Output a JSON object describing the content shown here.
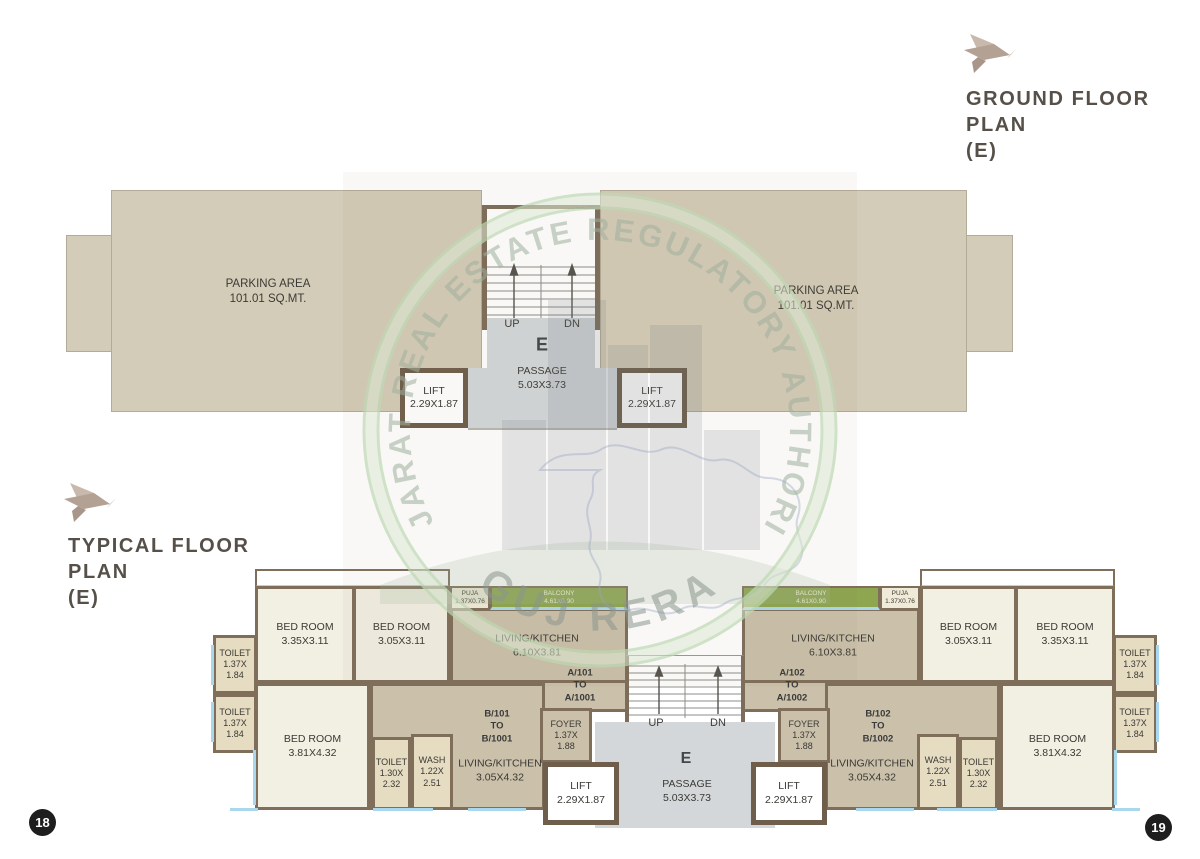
{
  "page_numbers": {
    "left": "18",
    "right": "19"
  },
  "watermark": {
    "arc_text_top": "GUJARAT REAL ESTATE REGULATORY AUTHORITY",
    "arc_text_bottom": "GUJ RERA"
  },
  "ground_plan": {
    "title_lines": [
      "GROUND FLOOR",
      "PLAN",
      "(E)"
    ],
    "parking_left_lines": [
      "PARKING AREA",
      "101.01 SQ.MT."
    ],
    "parking_right_lines": [
      "PARKING AREA",
      "101.01 SQ.MT."
    ],
    "up": "UP",
    "dn": "DN",
    "wing": "E",
    "passage_lines": [
      "PASSAGE",
      "5.03X3.73"
    ],
    "lift_left_lines": [
      "LIFT",
      "2.29X1.87"
    ],
    "lift_right_lines": [
      "LIFT",
      "2.29X1.87"
    ]
  },
  "typical_plan": {
    "title_lines": [
      "TYPICAL FLOOR",
      "PLAN",
      "(E)"
    ],
    "up": "UP",
    "dn": "DN",
    "wing": "E",
    "passage_lines": [
      "PASSAGE",
      "5.03X3.73"
    ],
    "rooms": [
      {
        "id": "toilet-left-upper",
        "lines": [
          "TOILET",
          "1.37X",
          "1.84"
        ]
      },
      {
        "id": "toilet-left-lower",
        "lines": [
          "TOILET",
          "1.37X",
          "1.84"
        ]
      },
      {
        "id": "bedroom-left-1",
        "lines": [
          "BED ROOM",
          "3.35X3.11"
        ]
      },
      {
        "id": "bedroom-left-2",
        "lines": [
          "BED ROOM",
          "3.05X3.11"
        ]
      },
      {
        "id": "puja-left",
        "lines": [
          "PUJA",
          "1.37X0.76"
        ]
      },
      {
        "id": "balcony-left",
        "lines": [
          "BALCONY",
          "4.61X0.90"
        ]
      },
      {
        "id": "living-kitchen-a-left",
        "lines": [
          "LIVING/KITCHEN",
          "6.10X3.81"
        ]
      },
      {
        "id": "unit-a-left",
        "lines": [
          "A/101",
          "TO",
          "A/1001"
        ]
      },
      {
        "id": "bedroom-left-3",
        "lines": [
          "BED ROOM",
          "3.81X4.32"
        ]
      },
      {
        "id": "toilet-left-3",
        "lines": [
          "TOILET",
          "1.30X",
          "2.32"
        ]
      },
      {
        "id": "wash-left",
        "lines": [
          "WASH",
          "1.22X",
          "2.51"
        ]
      },
      {
        "id": "living-kitchen-b-left",
        "lines": [
          "LIVING/KITCHEN",
          "3.05X4.32"
        ]
      },
      {
        "id": "unit-b-left",
        "lines": [
          "B/101",
          "TO",
          "B/1001"
        ]
      },
      {
        "id": "foyer-left",
        "lines": [
          "FOYER",
          "1.37X",
          "1.88"
        ]
      },
      {
        "id": "lift-left",
        "lines": [
          "LIFT",
          "2.29X1.87"
        ]
      },
      {
        "id": "lift-right",
        "lines": [
          "LIFT",
          "2.29X1.87"
        ]
      },
      {
        "id": "foyer-right",
        "lines": [
          "FOYER",
          "1.37X",
          "1.88"
        ]
      },
      {
        "id": "unit-a-right",
        "lines": [
          "A/102",
          "TO",
          "A/1002"
        ]
      },
      {
        "id": "living-kitchen-a-right",
        "lines": [
          "LIVING/KITCHEN",
          "6.10X3.81"
        ]
      },
      {
        "id": "balcony-right",
        "lines": [
          "BALCONY",
          "4.61X0.90"
        ]
      },
      {
        "id": "puja-right",
        "lines": [
          "PUJA",
          "1.37X0.76"
        ]
      },
      {
        "id": "bedroom-right-1",
        "lines": [
          "BED ROOM",
          "3.05X3.11"
        ]
      },
      {
        "id": "bedroom-right-2",
        "lines": [
          "BED ROOM",
          "3.35X3.11"
        ]
      },
      {
        "id": "toilet-right-upper",
        "lines": [
          "TOILET",
          "1.37X",
          "1.84"
        ]
      },
      {
        "id": "toilet-right-lower",
        "lines": [
          "TOILET",
          "1.37X",
          "1.84"
        ]
      },
      {
        "id": "bedroom-right-3",
        "lines": [
          "BED ROOM",
          "3.81X4.32"
        ]
      },
      {
        "id": "toilet-right-3",
        "lines": [
          "TOILET",
          "1.30X",
          "2.32"
        ]
      },
      {
        "id": "wash-right",
        "lines": [
          "WASH",
          "1.22X",
          "2.51"
        ]
      },
      {
        "id": "living-kitchen-b-right",
        "lines": [
          "LIVING/KITCHEN",
          "3.05X4.32"
        ]
      },
      {
        "id": "unit-b-right",
        "lines": [
          "B/102",
          "TO",
          "B/1002"
        ]
      }
    ]
  },
  "colors": {
    "balcony_green": "#8da64f",
    "wall": "#7e6e5a",
    "parking_fill": "#d3ccb8",
    "passage_gray": "#d3d7d9",
    "window_blue": "#a9d8ee",
    "bird_accent": "#b3a193"
  }
}
